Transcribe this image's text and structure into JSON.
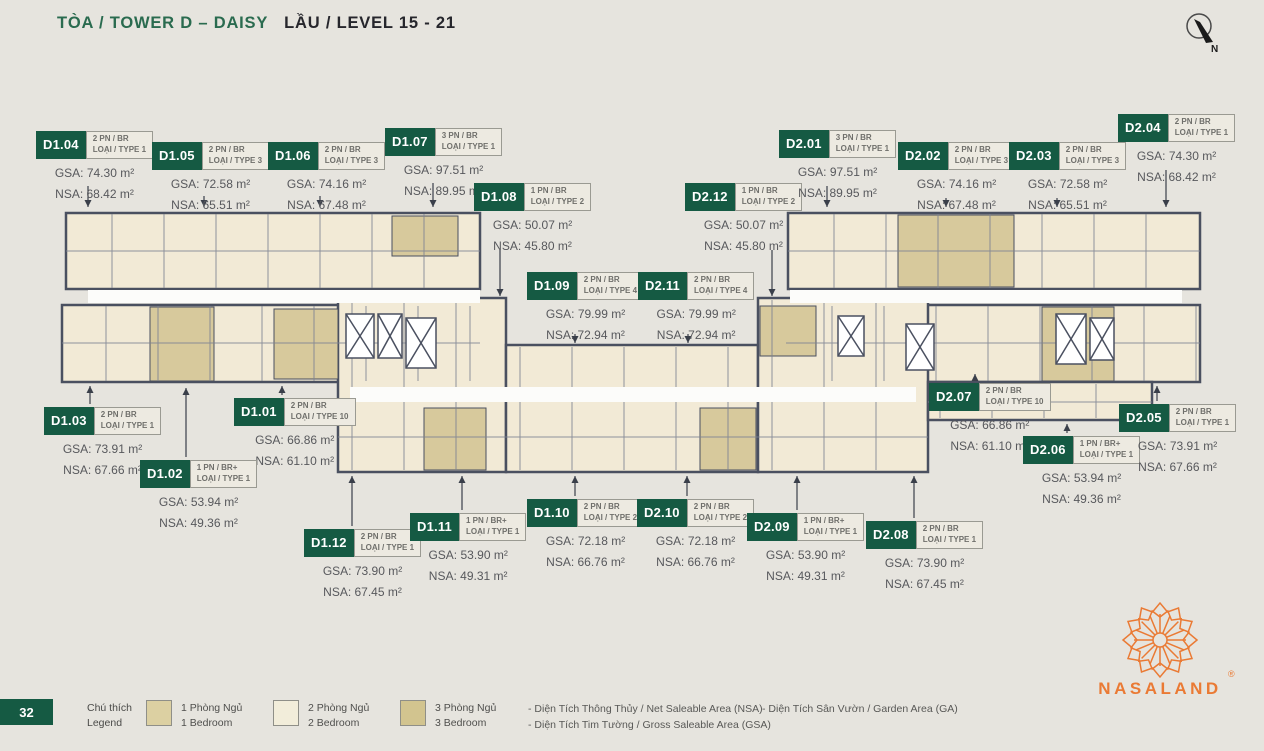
{
  "header": {
    "title_green": "TÒA / TOWER D – DAISY",
    "title_dark": "LẦU / LEVEL 15 - 21"
  },
  "compass": {
    "label": "N"
  },
  "page_number": "32",
  "colors": {
    "green": "#155a43",
    "orange": "#EA7A34",
    "wall": "#4a5060",
    "cream": "#f2ead6",
    "tan": "#d7c99c"
  },
  "legend": {
    "title_line1": "Chú thích",
    "title_line2": "Legend",
    "items": [
      {
        "line1": "1 Phòng Ngủ",
        "line2": "1 Bedroom",
        "color": "#dcd0a2",
        "x": 0
      },
      {
        "line1": "2 Phòng Ngủ",
        "line2": "2 Bedroom",
        "color": "#f2edda",
        "x": 127
      },
      {
        "line1": "3 Phòng Ngủ",
        "line2": "3 Bedroom",
        "color": "#d2c48f",
        "x": 254
      }
    ],
    "notes_col1": [
      "-  Diện Tích Thông Thủy / Net Saleable Area (NSA)",
      "-  Diện Tích Tim Tường / Gross Saleable Area (GSA)"
    ],
    "notes_col2": [
      "-  Diện Tích Sân Vườn / Garden Area (GA)"
    ]
  },
  "logo": {
    "name": "NASALAND",
    "reg": "®"
  },
  "units": [
    {
      "id": "D1.04",
      "bed": "2 PN / BR",
      "type": "LOẠI / TYPE 1",
      "gsa": "GSA: 74.30 m²",
      "nsa": "NSA: 68.42 m²",
      "x": 36,
      "y": 131,
      "lx": 88,
      "ly1": 186,
      "ly2": 207
    },
    {
      "id": "D1.05",
      "bed": "2 PN / BR",
      "type": "LOẠI / TYPE 3",
      "gsa": "GSA: 72.58 m²",
      "nsa": "NSA: 65.51 m²",
      "x": 152,
      "y": 142,
      "lx": 204,
      "ly1": 196,
      "ly2": 207
    },
    {
      "id": "D1.06",
      "bed": "2 PN / BR",
      "type": "LOẠI / TYPE 3",
      "gsa": "GSA: 74.16 m²",
      "nsa": "NSA: 67.48 m²",
      "x": 268,
      "y": 142,
      "lx": 320,
      "ly1": 196,
      "ly2": 207
    },
    {
      "id": "D1.07",
      "bed": "3 PN / BR",
      "type": "LOẠI / TYPE 1",
      "gsa": "GSA: 97.51 m²",
      "nsa": "NSA: 89.95 m²",
      "x": 385,
      "y": 128,
      "lx": 433,
      "ly1": 183,
      "ly2": 207
    },
    {
      "id": "D1.08",
      "bed": "1 PN / BR",
      "type": "LOẠI / TYPE 2",
      "gsa": "GSA: 50.07 m²",
      "nsa": "NSA: 45.80 m²",
      "x": 474,
      "y": 183,
      "lx": 500,
      "ly1": 250,
      "ly2": 296
    },
    {
      "id": "D1.09",
      "bed": "2 PN / BR",
      "type": "LOẠI / TYPE 4",
      "gsa": "GSA: 79.99 m²",
      "nsa": "NSA: 72.94 m²",
      "x": 527,
      "y": 272,
      "lx": 575,
      "ly1": 334,
      "ly2": 343
    },
    {
      "id": "D2.11",
      "bed": "2 PN / BR",
      "type": "LOẠI / TYPE 4",
      "gsa": "GSA: 79.99 m²",
      "nsa": "NSA: 72.94 m²",
      "x": 638,
      "y": 272,
      "lx": 688,
      "ly1": 334,
      "ly2": 343
    },
    {
      "id": "D2.12",
      "bed": "1 PN / BR",
      "type": "LOẠI / TYPE 2",
      "gsa": "GSA: 50.07 m²",
      "nsa": "NSA: 45.80 m²",
      "x": 685,
      "y": 183,
      "lx": 772,
      "ly1": 250,
      "ly2": 296
    },
    {
      "id": "D2.01",
      "bed": "3 PN / BR",
      "type": "LOẠI / TYPE 1",
      "gsa": "GSA: 97.51 m²",
      "nsa": "NSA: 89.95 m²",
      "x": 779,
      "y": 130,
      "lx": 827,
      "ly1": 186,
      "ly2": 207
    },
    {
      "id": "D2.02",
      "bed": "2 PN / BR",
      "type": "LOẠI / TYPE 3",
      "gsa": "GSA: 74.16 m²",
      "nsa": "NSA: 67.48 m²",
      "x": 898,
      "y": 142,
      "lx": 946,
      "ly1": 198,
      "ly2": 207
    },
    {
      "id": "D2.03",
      "bed": "2 PN / BR",
      "type": "LOẠI / TYPE 3",
      "gsa": "GSA: 72.58 m²",
      "nsa": "NSA: 65.51 m²",
      "x": 1009,
      "y": 142,
      "lx": 1057,
      "ly1": 198,
      "ly2": 207
    },
    {
      "id": "D2.04",
      "bed": "2 PN / BR",
      "type": "LOẠI / TYPE 1",
      "gsa": "GSA: 74.30 m²",
      "nsa": "NSA: 68.42 m²",
      "x": 1118,
      "y": 114,
      "lx": 1166,
      "ly1": 170,
      "ly2": 207
    },
    {
      "id": "D1.03",
      "bed": "2 PN / BR",
      "type": "LOẠI / TYPE 1",
      "gsa": "GSA: 73.91 m²",
      "nsa": "NSA: 67.66 m²",
      "x": 44,
      "y": 407,
      "lx": 90,
      "ly1": 404,
      "ly2": 386
    },
    {
      "id": "D1.01",
      "bed": "2 PN / BR",
      "type": "LOẠI / TYPE 10",
      "gsa": "GSA: 66.86 m²",
      "nsa": "NSA: 61.10 m²",
      "x": 234,
      "y": 398,
      "lx": 282,
      "ly1": 395,
      "ly2": 386
    },
    {
      "id": "D1.02",
      "bed": "1 PN / BR+",
      "type": "LOẠI / TYPE 1",
      "gsa": "GSA: 53.94 m²",
      "nsa": "NSA: 49.36 m²",
      "x": 140,
      "y": 460,
      "lx": 186,
      "ly1": 457,
      "ly2": 388
    },
    {
      "id": "D1.12",
      "bed": "2 PN / BR",
      "type": "LOẠI / TYPE 1",
      "gsa": "GSA: 73.90 m²",
      "nsa": "NSA: 67.45 m²",
      "x": 304,
      "y": 529,
      "lx": 352,
      "ly1": 526,
      "ly2": 476
    },
    {
      "id": "D1.11",
      "bed": "1 PN / BR+",
      "type": "LOẠI / TYPE 1",
      "gsa": "GSA: 53.90 m²",
      "nsa": "NSA: 49.31 m²",
      "x": 410,
      "y": 513,
      "lx": 462,
      "ly1": 510,
      "ly2": 476
    },
    {
      "id": "D1.10",
      "bed": "2 PN / BR",
      "type": "LOẠI / TYPE 2",
      "gsa": "GSA: 72.18 m²",
      "nsa": "NSA: 66.76 m²",
      "x": 527,
      "y": 499,
      "lx": 575,
      "ly1": 496,
      "ly2": 476
    },
    {
      "id": "D2.10",
      "bed": "2 PN / BR",
      "type": "LOẠI / TYPE 2",
      "gsa": "GSA: 72.18 m²",
      "nsa": "NSA: 66.76 m²",
      "x": 637,
      "y": 499,
      "lx": 687,
      "ly1": 496,
      "ly2": 476
    },
    {
      "id": "D2.09",
      "bed": "1 PN / BR+",
      "type": "LOẠI / TYPE 1",
      "gsa": "GSA: 53.90 m²",
      "nsa": "NSA: 49.31 m²",
      "x": 747,
      "y": 513,
      "lx": 797,
      "ly1": 510,
      "ly2": 476
    },
    {
      "id": "D2.08",
      "bed": "2 PN / BR",
      "type": "LOẠI / TYPE 1",
      "gsa": "GSA: 73.90 m²",
      "nsa": "NSA: 67.45 m²",
      "x": 866,
      "y": 521,
      "lx": 914,
      "ly1": 518,
      "ly2": 476
    },
    {
      "id": "D2.07",
      "bed": "2 PN / BR",
      "type": "LOẠI / TYPE 10",
      "gsa": "GSA: 66.86 m²",
      "nsa": "NSA: 61.10 m²",
      "x": 929,
      "y": 383,
      "lx": 975,
      "ly1": 381,
      "ly2": 374
    },
    {
      "id": "D2.06",
      "bed": "1 PN / BR+",
      "type": "LOẠI / TYPE 1",
      "gsa": "GSA: 53.94 m²",
      "nsa": "NSA: 49.36 m²",
      "x": 1023,
      "y": 436,
      "lx": 1067,
      "ly1": 433,
      "ly2": 424
    },
    {
      "id": "D2.05",
      "bed": "2 PN / BR",
      "type": "LOẠI / TYPE 1",
      "gsa": "GSA: 73.91 m²",
      "nsa": "NSA: 67.66 m²",
      "x": 1119,
      "y": 404,
      "lx": 1157,
      "ly1": 401,
      "ly2": 386
    }
  ]
}
